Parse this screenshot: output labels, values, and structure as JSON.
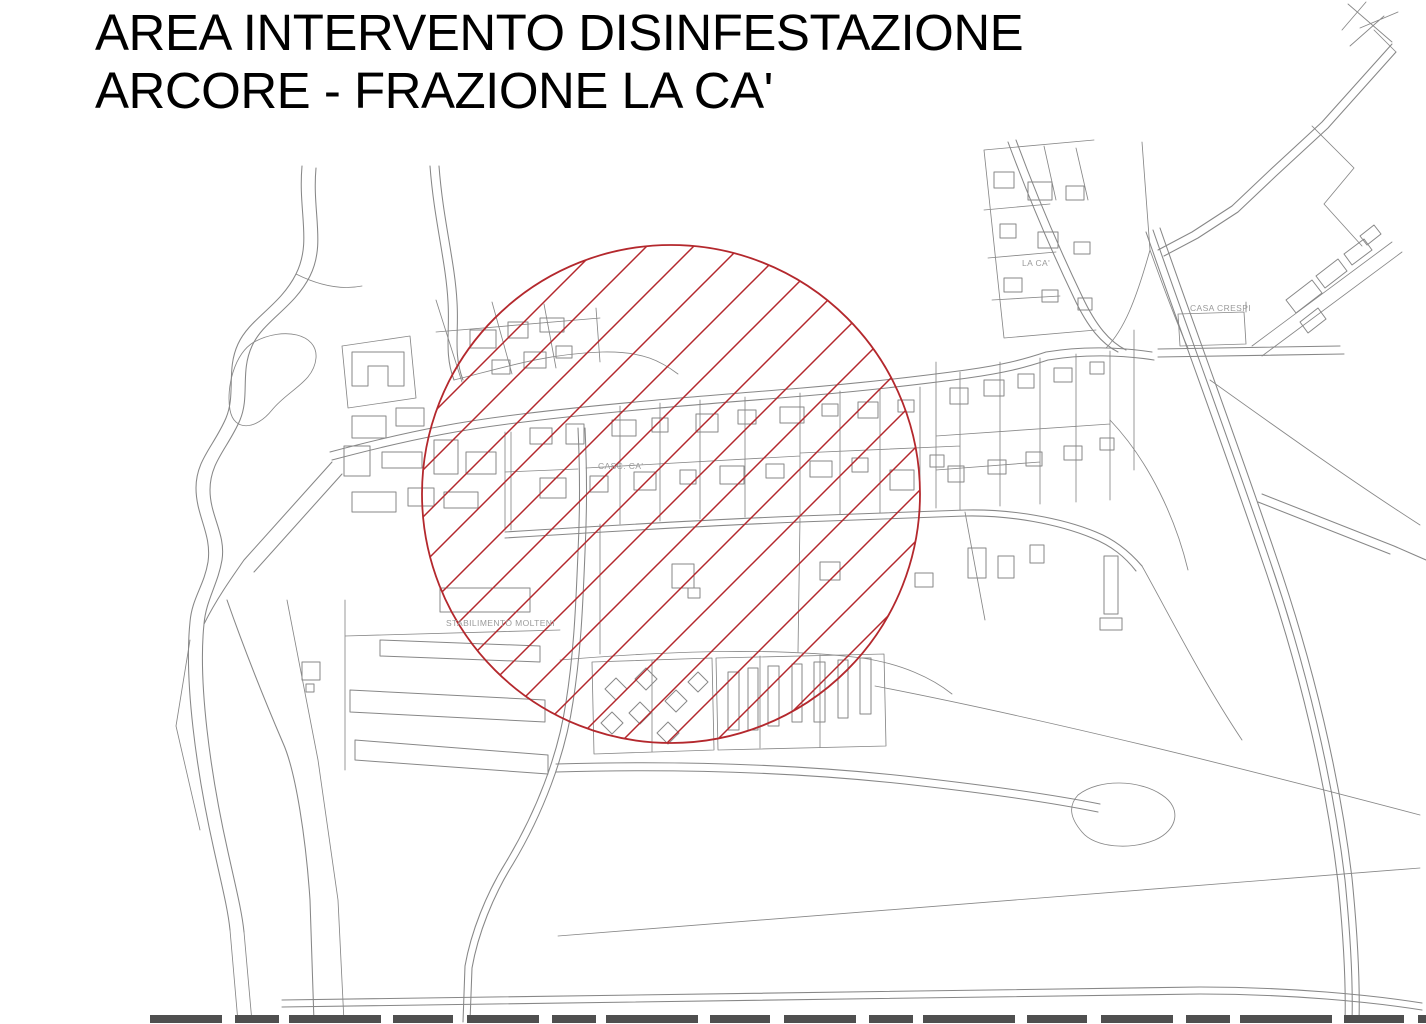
{
  "title": {
    "line1": "AREA INTERVENTO DISINFESTAZIONE",
    "line2": "ARCORE - FRAZIONE LA CA'"
  },
  "map": {
    "labels": {
      "la_ca": "LA CA'",
      "casa_crespi": "CASA CRESPI",
      "casc_ca": "CASC. CA'",
      "stabilimento_molteni": "STABILIMENTO MOLTENI"
    },
    "zone": {
      "shape": "circle",
      "fill_pattern": "diagonal-red-hatch"
    }
  },
  "colors": {
    "background": "#ffffff",
    "title_black": "#000000",
    "map_lines": "#878787",
    "label_gray": "#9a9a9a",
    "zone_red": "#b4282d"
  }
}
